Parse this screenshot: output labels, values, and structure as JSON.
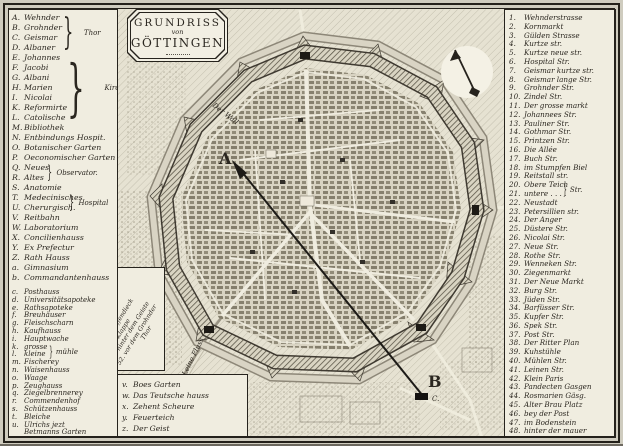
{
  "title": {
    "line1": "GRUNDRISS",
    "line2": "von",
    "line3": "GÖTTINGEN"
  },
  "left_legend": {
    "upper": [
      {
        "k": "A.",
        "t": "Wehnder"
      },
      {
        "k": "B.",
        "t": "Grohnder"
      },
      {
        "k": "C.",
        "t": "Geismar"
      },
      {
        "k": "D.",
        "t": "Albaner"
      },
      {
        "k": "E.",
        "t": "Johannes"
      },
      {
        "k": "F.",
        "t": "Jacobi"
      },
      {
        "k": "G.",
        "t": "Albani"
      },
      {
        "k": "H.",
        "t": "Marien"
      },
      {
        "k": "I.",
        "t": "Nicolai"
      },
      {
        "k": "K.",
        "t": "Reformirte"
      },
      {
        "k": "L.",
        "t": "Catolische"
      },
      {
        "k": "M.",
        "t": "Bibliothek"
      },
      {
        "k": "N.",
        "t": "Entbindungs Hospit."
      },
      {
        "k": "O.",
        "t": "Botanischer Garten"
      },
      {
        "k": "P.",
        "t": "Oeconomischer Garten"
      },
      {
        "k": "Q.",
        "t": "Neues"
      },
      {
        "k": "R.",
        "t": "Altes"
      },
      {
        "k": "S.",
        "t": "Anatomie"
      },
      {
        "k": "T.",
        "t": "Medecinisches"
      },
      {
        "k": "U.",
        "t": "Cherurgisch."
      },
      {
        "k": "V.",
        "t": "Reitbahn"
      },
      {
        "k": "W.",
        "t": "Laboratorium"
      },
      {
        "k": "X.",
        "t": "Concilienhauss"
      },
      {
        "k": "Y.",
        "t": "Ex Prefectur"
      },
      {
        "k": "Z.",
        "t": "Rath Hauss"
      },
      {
        "k": "a.",
        "t": "Gimnasium"
      },
      {
        "k": "b.",
        "t": "Commandantenhauss"
      }
    ],
    "lower": [
      {
        "k": "c.",
        "t": "Posthauss"
      },
      {
        "k": "d.",
        "t": "Universitätsapoteke"
      },
      {
        "k": "e.",
        "t": "Rathsapoteke"
      },
      {
        "k": "f.",
        "t": "Breuhäuser"
      },
      {
        "k": "g.",
        "t": "Fleischscharn"
      },
      {
        "k": "h.",
        "t": "Kaufhauss"
      },
      {
        "k": "i.",
        "t": "Hauptwache"
      },
      {
        "k": "k.",
        "t": "grosse"
      },
      {
        "k": "l.",
        "t": "kleine"
      },
      {
        "k": "m.",
        "t": "Fischerey"
      },
      {
        "k": "n.",
        "t": "Waisenhauss"
      },
      {
        "k": "o.",
        "t": "Waage"
      },
      {
        "k": "p.",
        "t": "Zeughauss"
      },
      {
        "k": "q.",
        "t": "Ziegelbrennerey"
      },
      {
        "k": "r.",
        "t": "Commendenhof"
      },
      {
        "k": "s.",
        "t": "Schützenhauss"
      },
      {
        "k": "t.",
        "t": "Bleiche"
      },
      {
        "k": "u.",
        "t": "Ulrichs jezt"
      },
      {
        "k": "",
        "t": "Betmanns Garten"
      }
    ],
    "braces": {
      "thor": "Thor",
      "kirche": "Kirche",
      "observator": "Observator.",
      "hospital": "Hospital",
      "muhle": "mühle"
    }
  },
  "side_legend_rotated": {
    "lines": [
      "49. am Pfaffendieck",
      "50. im Klappe",
      "51. hinter dem Geiste",
      "52. vor dem Grohnder"
    ],
    "last": "Thor"
  },
  "bottom_legend": {
    "items": [
      {
        "k": "v.",
        "t": "Boes Garten"
      },
      {
        "k": "w.",
        "t": "Das Teutsche hauss"
      },
      {
        "k": "x.",
        "t": "Zehent Scheure"
      },
      {
        "k": "y.",
        "t": "Feuerteich"
      },
      {
        "k": "z.",
        "t": "Der Geist"
      }
    ]
  },
  "right_legend": {
    "brace_label": "Str.",
    "items": [
      {
        "n": "1.",
        "t": "Wehnderstrasse"
      },
      {
        "n": "2.",
        "t": "Kornmarkt"
      },
      {
        "n": "3.",
        "t": "Gülden Strasse"
      },
      {
        "n": "4.",
        "t": "Kurtze str."
      },
      {
        "n": "5.",
        "t": "Kurtze neue str."
      },
      {
        "n": "6.",
        "t": "Hospital Str."
      },
      {
        "n": "7.",
        "t": "Geismar kurtze str."
      },
      {
        "n": "8.",
        "t": "Geismar lange Str."
      },
      {
        "n": "9.",
        "t": "Grohnder Str."
      },
      {
        "n": "10.",
        "t": "Zindel Str."
      },
      {
        "n": "11.",
        "t": "Der grosse markt"
      },
      {
        "n": "12.",
        "t": "Johannees Str."
      },
      {
        "n": "13.",
        "t": "Pauliner Str."
      },
      {
        "n": "14.",
        "t": "Gothmar Str."
      },
      {
        "n": "15.",
        "t": "Printzen Str."
      },
      {
        "n": "16.",
        "t": "Die Allée"
      },
      {
        "n": "17.",
        "t": "Buch Str."
      },
      {
        "n": "18.",
        "t": "im Stumpfen Biel"
      },
      {
        "n": "19.",
        "t": "Reitstall str."
      },
      {
        "n": "20.",
        "t": "Obere Teich"
      },
      {
        "n": "21.",
        "t": "untere . . . ."
      },
      {
        "n": "22.",
        "t": "Neustadt"
      },
      {
        "n": "23.",
        "t": "Petersillien str."
      },
      {
        "n": "24.",
        "t": "Der Anger"
      },
      {
        "n": "25.",
        "t": "Düstere Str."
      },
      {
        "n": "26.",
        "t": "Nicolai Str."
      },
      {
        "n": "27.",
        "t": "Neue Str."
      },
      {
        "n": "28.",
        "t": "Rothe Str."
      },
      {
        "n": "29.",
        "t": "Wenneken Str."
      },
      {
        "n": "30.",
        "t": "Ziegenmarkt"
      },
      {
        "n": "31.",
        "t": "Der Neue Markt"
      },
      {
        "n": "32.",
        "t": "Burg Str."
      },
      {
        "n": "33.",
        "t": "Jüden Str."
      },
      {
        "n": "34.",
        "t": "Barfüsser Str."
      },
      {
        "n": "35.",
        "t": "Kupfer Str."
      },
      {
        "n": "36.",
        "t": "Spek Str."
      },
      {
        "n": "37.",
        "t": "Post Str."
      },
      {
        "n": "38.",
        "t": "Der Ritter Plan"
      },
      {
        "n": "39.",
        "t": "Kuhstühle"
      },
      {
        "n": "40.",
        "t": "Mühlen Str."
      },
      {
        "n": "41.",
        "t": "Leinen Str."
      },
      {
        "n": "42.",
        "t": "Klein Paris"
      },
      {
        "n": "43.",
        "t": "Pandecten Gasgen"
      },
      {
        "n": "44.",
        "t": "Rosmarien Gäsg."
      },
      {
        "n": "45.",
        "t": "Alter Brau Platz"
      },
      {
        "n": "46.",
        "t": "bey der Post"
      },
      {
        "n": "47.",
        "t": "im Bodenstein"
      },
      {
        "n": "48.",
        "t": "hinter der mauer"
      }
    ]
  },
  "map": {
    "marker_a": "A",
    "marker_b": "B",
    "marker_c": "C.",
    "label_wall": "Der Wall",
    "label_river": "Leine Fluss"
  },
  "colors": {
    "paper": "#e9e6d7",
    "ink": "#2b2720",
    "panel": "#f0ede0"
  }
}
